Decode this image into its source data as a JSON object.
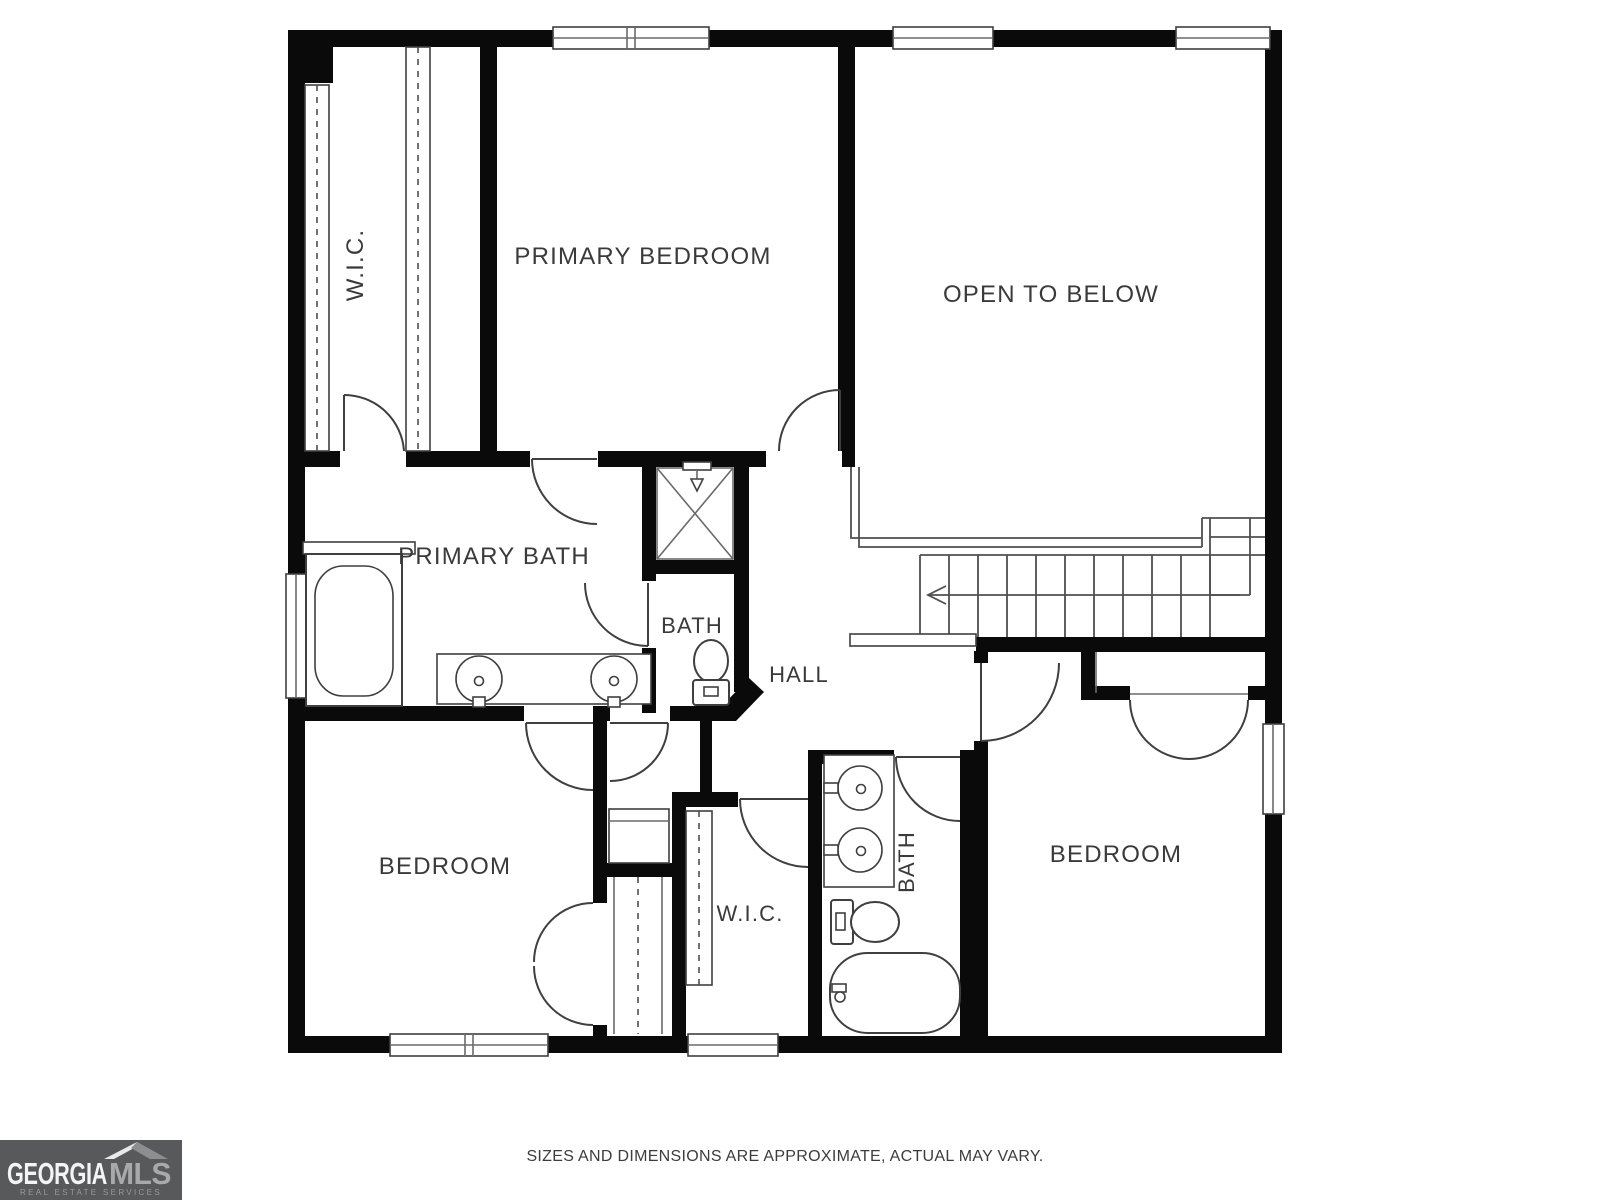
{
  "colors": {
    "wall": "#0a0a0a",
    "fixture_line": "#3f3f3f",
    "stair_line": "#4f4f4f",
    "label_text": "#3a3a3a",
    "background": "#ffffff",
    "logo_background": "#58595b",
    "logo_text_primary": "#f4f4f4",
    "logo_text_secondary": "#a8a9ab",
    "logo_tagline": "#97989a",
    "disclaimer_text": "#3c3c3c"
  },
  "rooms": {
    "wic_top": {
      "label": "W.I.C."
    },
    "primary_bedroom": {
      "label": "PRIMARY BEDROOM"
    },
    "open_to_below": {
      "label": "OPEN TO BELOW"
    },
    "primary_bath": {
      "label": "PRIMARY BATH"
    },
    "bath_middle": {
      "label": "BATH"
    },
    "hall": {
      "label": "HALL"
    },
    "bedroom_left": {
      "label": "BEDROOM"
    },
    "wic_bottom": {
      "label": "W.I.C."
    },
    "bath_bottom": {
      "label": "BATH"
    },
    "bedroom_right": {
      "label": "BEDROOM"
    }
  },
  "footer": {
    "disclaimer": "SIZES AND DIMENSIONS ARE APPROXIMATE, ACTUAL MAY VARY."
  },
  "logo": {
    "brand_primary": "GEORGIA",
    "brand_secondary": "MLS",
    "tagline": "REAL ESTATE SERVICES"
  }
}
